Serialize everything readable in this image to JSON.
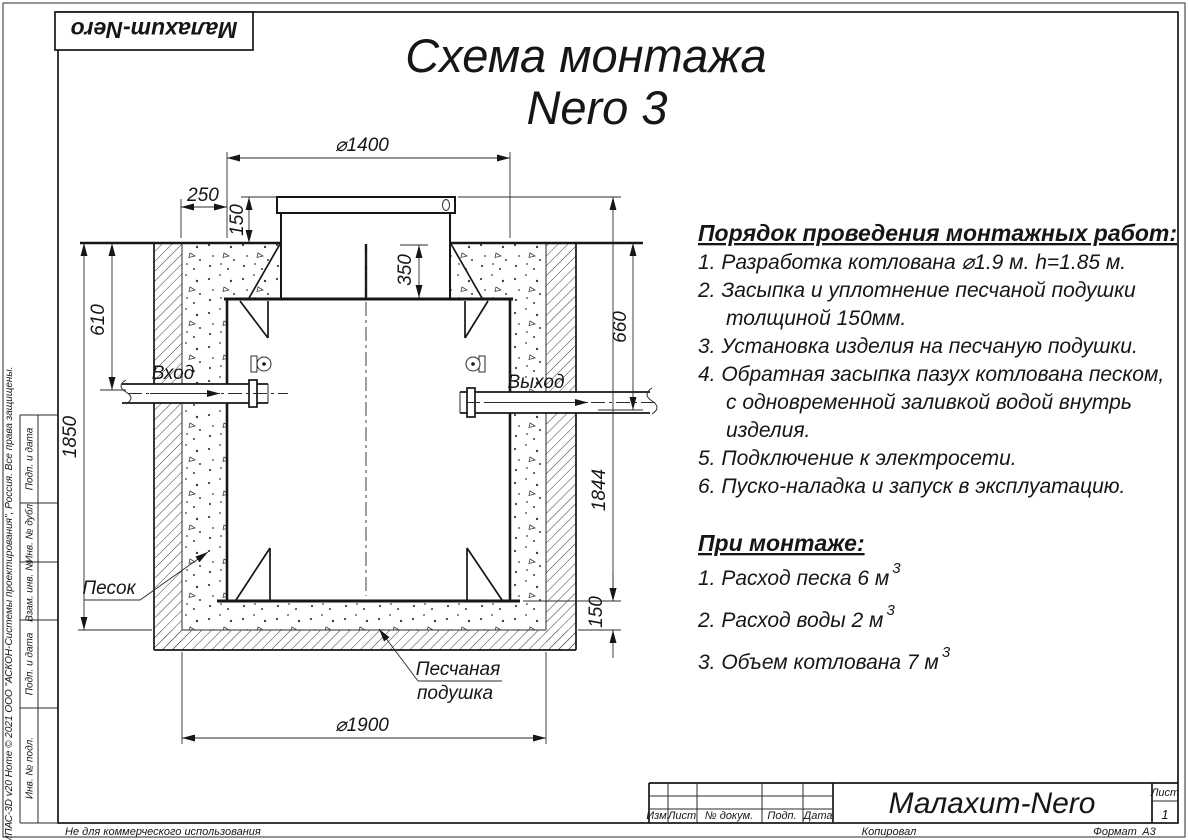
{
  "sheet": {
    "logo_text": "Малахит-Nero",
    "title_line1": "Схема монтажа",
    "title_line2": "Nero 3",
    "kompas_credit": "КОМПАС-3D v20 Home © 2021 ООО \"АСКОН-Системы проектирования\", Россия. Все права защищены.",
    "not_commercial": "Не для коммерческого использования",
    "stamp_cells": [
      "Подп. и дата",
      "Инв. № дубл.",
      "Взам. инв. №",
      "Подп. и дата",
      "Инв. № подл."
    ]
  },
  "instructions": {
    "heading": "Порядок проведения монтажных работ:",
    "lines": [
      {
        "text": "1. Разработка котлована ⌀1.9 м. h=1.85 м."
      },
      {
        "text": "2. Засыпка и уплотнение песчаной подушки"
      },
      {
        "text": "толщиной 150мм."
      },
      {
        "text": "3. Установка изделия на песчаную подушки."
      },
      {
        "text": "4. Обратная засыпка пазух котлована песком,"
      },
      {
        "text": "с одновременной заливкой водой внутрь"
      },
      {
        "text": "изделия."
      },
      {
        "text": "5. Подключение к электросети."
      },
      {
        "text": "6. Пуско-наладка и запуск в эксплуатацию."
      }
    ],
    "subheading": "При монтаже:",
    "notes": [
      {
        "text": "1. Расход песка 6 м",
        "sup": "3"
      },
      {
        "text": "2. Расход воды 2 м",
        "sup": "3"
      },
      {
        "text": "3. Объем котлована 7 м",
        "sup": "3"
      }
    ]
  },
  "drawing": {
    "dim_d1400": "⌀1400",
    "dim_250": "250",
    "dim_150_top": "150",
    "dim_350": "350",
    "dim_610": "610",
    "dim_1850": "1850",
    "dim_660": "660",
    "dim_1844": "1844",
    "dim_150_bottom": "150",
    "dim_d1900": "⌀1900",
    "label_inlet": "Вход",
    "label_outlet": "Выход",
    "label_sand": "Песок",
    "label_cushion_1": "Песчаная",
    "label_cushion_2": "подушка"
  },
  "title_block": {
    "col_izm": "Изм.",
    "col_list": "Лист",
    "col_docnum": "№ докум.",
    "col_podp": "Подп.",
    "col_data": "Дата",
    "company": "Малахит-Nero",
    "sheet_label": "Лист",
    "sheet_number": "1",
    "copied": "Копировал",
    "format_label": "Формат",
    "format_value": "А3"
  }
}
